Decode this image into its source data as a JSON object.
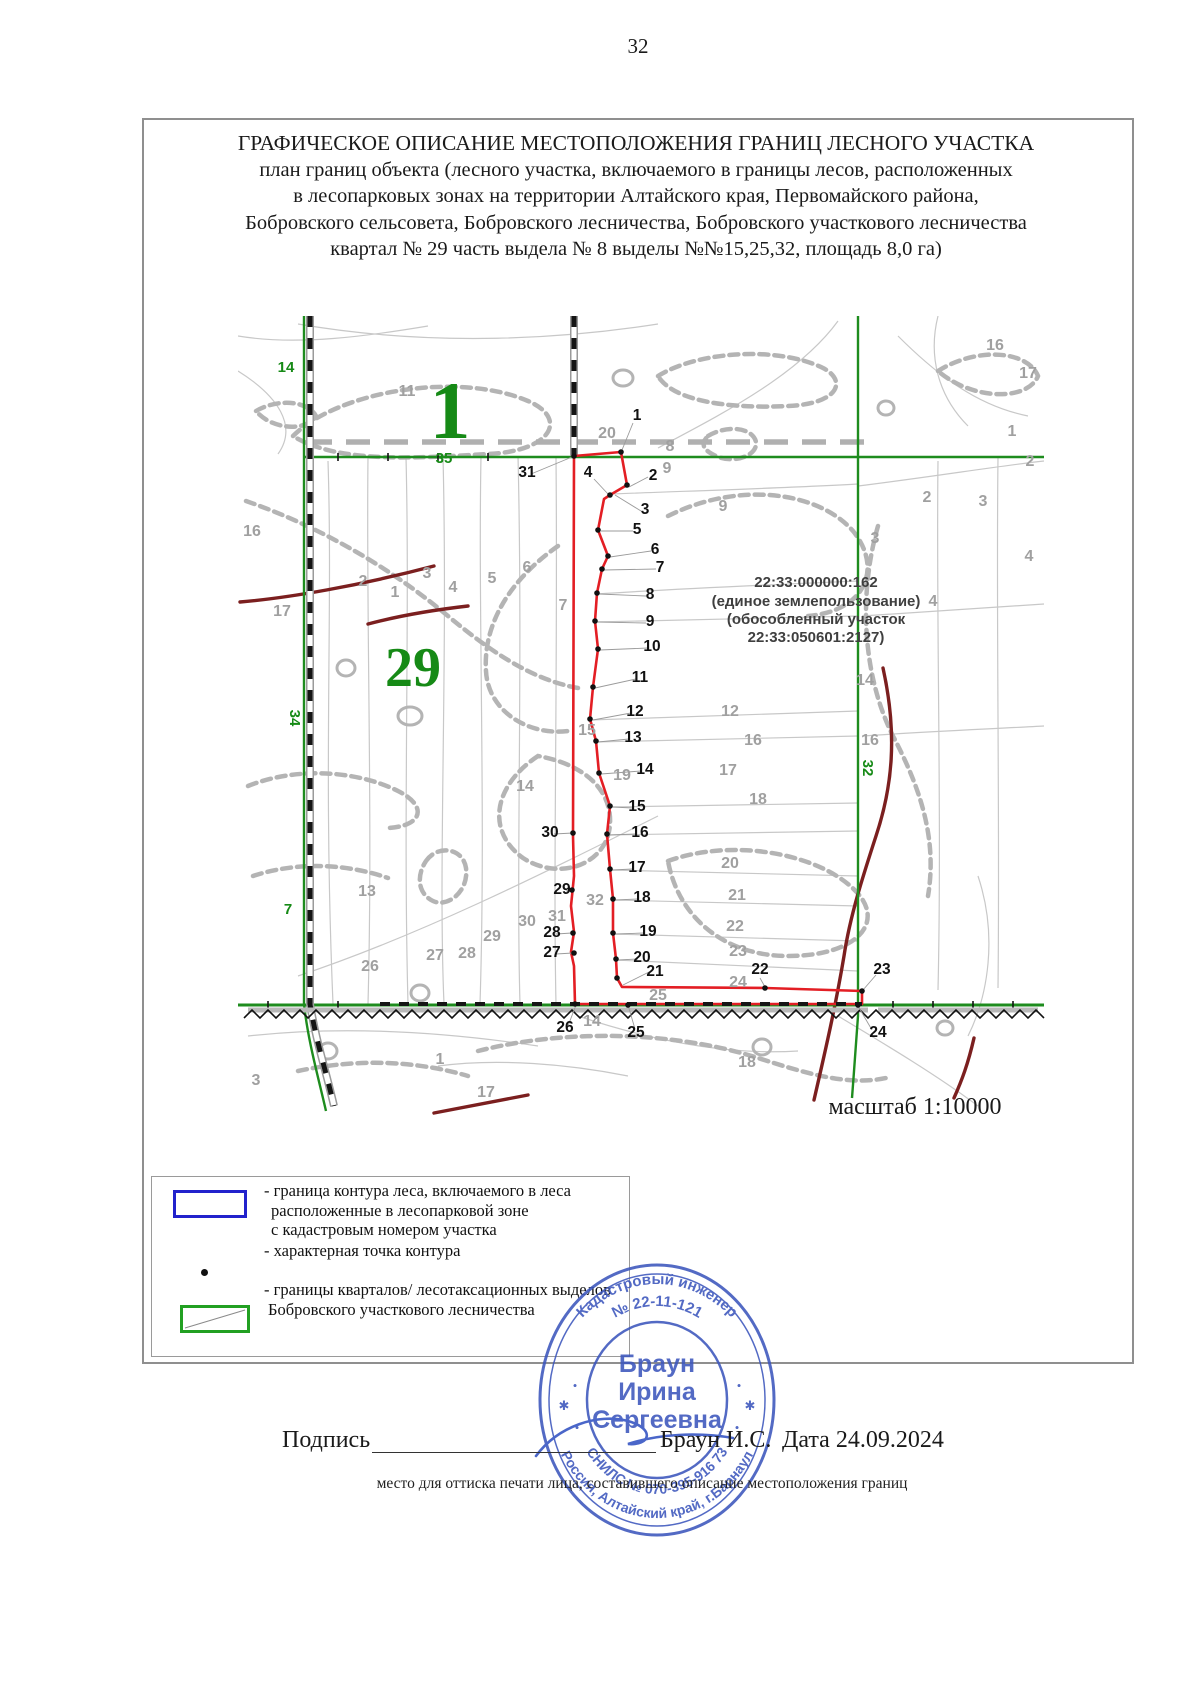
{
  "page_number": "32",
  "title": {
    "line1": "ГРАФИЧЕСКОЕ ОПИСАНИЕ МЕСТОПОЛОЖЕНИЯ ГРАНИЦ ЛЕСНОГО УЧАСТКА",
    "line2": "план границ объекта (лесного участка, включаемого в границы лесов, расположенных",
    "line3": "в лесопарковых зонах на территории Алтайского края, Первомайского района,",
    "line4": "Бобровского сельсовета, Бобровского лесничества, Бобровского участкового лесничества",
    "line5": "квартал № 29 часть выдела № 8 выделы №№15,25,32, площадь 8,0 га)"
  },
  "map": {
    "scale_label": "масштаб 1:10000",
    "cadastral_note": [
      "22:33:000000:162",
      "(единое землепользование)",
      "(обособленный участок",
      "22:33:050601:2127)"
    ],
    "labels": [
      {
        "t": "1",
        "x": 212,
        "y": 122,
        "c": "q1"
      },
      {
        "t": "29",
        "x": 175,
        "y": 370,
        "c": "q2"
      },
      {
        "t": "35",
        "x": 206,
        "y": 147,
        "c": "s"
      },
      {
        "t": "14",
        "x": 48,
        "y": 56,
        "c": "s"
      },
      {
        "t": "34",
        "x": 52,
        "y": 402,
        "c": "s",
        "r": 90
      },
      {
        "t": "7",
        "x": 50,
        "y": 598,
        "c": "s"
      },
      {
        "t": "32",
        "x": 625,
        "y": 452,
        "c": "s",
        "r": 90
      },
      {
        "t": "11",
        "x": 169,
        "y": 80,
        "c": "g"
      },
      {
        "t": "16",
        "x": 14,
        "y": 220,
        "c": "g"
      },
      {
        "t": "17",
        "x": 44,
        "y": 300,
        "c": "g"
      },
      {
        "t": "2",
        "x": 125,
        "y": 270,
        "c": "g"
      },
      {
        "t": "1",
        "x": 157,
        "y": 281,
        "c": "g"
      },
      {
        "t": "3",
        "x": 189,
        "y": 262,
        "c": "g"
      },
      {
        "t": "4",
        "x": 215,
        "y": 276,
        "c": "g"
      },
      {
        "t": "5",
        "x": 254,
        "y": 267,
        "c": "g"
      },
      {
        "t": "6",
        "x": 289,
        "y": 256,
        "c": "g"
      },
      {
        "t": "7",
        "x": 325,
        "y": 294,
        "c": "g"
      },
      {
        "t": "20",
        "x": 369,
        "y": 122,
        "c": "g"
      },
      {
        "t": "8",
        "x": 432,
        "y": 135,
        "c": "g"
      },
      {
        "t": "9",
        "x": 429,
        "y": 157,
        "c": "g"
      },
      {
        "t": "16",
        "x": 757,
        "y": 34,
        "c": "g"
      },
      {
        "t": "17",
        "x": 790,
        "y": 62,
        "c": "g"
      },
      {
        "t": "1",
        "x": 774,
        "y": 120,
        "c": "g"
      },
      {
        "t": "2",
        "x": 792,
        "y": 150,
        "c": "g"
      },
      {
        "t": "9",
        "x": 485,
        "y": 195,
        "c": "g"
      },
      {
        "t": "2",
        "x": 689,
        "y": 186,
        "c": "g"
      },
      {
        "t": "3",
        "x": 637,
        "y": 227,
        "c": "g"
      },
      {
        "t": "3",
        "x": 745,
        "y": 190,
        "c": "g"
      },
      {
        "t": "4",
        "x": 695,
        "y": 290,
        "c": "g"
      },
      {
        "t": "4",
        "x": 791,
        "y": 245,
        "c": "g"
      },
      {
        "t": "12",
        "x": 492,
        "y": 400,
        "c": "g"
      },
      {
        "t": "14",
        "x": 627,
        "y": 369,
        "c": "g"
      },
      {
        "t": "15",
        "x": 349,
        "y": 419,
        "c": "g"
      },
      {
        "t": "16",
        "x": 515,
        "y": 429,
        "c": "g"
      },
      {
        "t": "16",
        "x": 632,
        "y": 429,
        "c": "g"
      },
      {
        "t": "17",
        "x": 490,
        "y": 459,
        "c": "g"
      },
      {
        "t": "18",
        "x": 520,
        "y": 488,
        "c": "g"
      },
      {
        "t": "19",
        "x": 384,
        "y": 464,
        "c": "g"
      },
      {
        "t": "20",
        "x": 492,
        "y": 552,
        "c": "g"
      },
      {
        "t": "21",
        "x": 499,
        "y": 584,
        "c": "g"
      },
      {
        "t": "22",
        "x": 497,
        "y": 615,
        "c": "g"
      },
      {
        "t": "23",
        "x": 500,
        "y": 640,
        "c": "g"
      },
      {
        "t": "24",
        "x": 500,
        "y": 671,
        "c": "g"
      },
      {
        "t": "25",
        "x": 420,
        "y": 684,
        "c": "g"
      },
      {
        "t": "13",
        "x": 129,
        "y": 580,
        "c": "g"
      },
      {
        "t": "26",
        "x": 132,
        "y": 655,
        "c": "g"
      },
      {
        "t": "27",
        "x": 197,
        "y": 644,
        "c": "g"
      },
      {
        "t": "28",
        "x": 229,
        "y": 642,
        "c": "g"
      },
      {
        "t": "29",
        "x": 254,
        "y": 625,
        "c": "g"
      },
      {
        "t": "30",
        "x": 289,
        "y": 610,
        "c": "g"
      },
      {
        "t": "31",
        "x": 319,
        "y": 605,
        "c": "g"
      },
      {
        "t": "32",
        "x": 357,
        "y": 589,
        "c": "g"
      },
      {
        "t": "14",
        "x": 287,
        "y": 475,
        "c": "g"
      },
      {
        "t": "14",
        "x": 354,
        "y": 710,
        "c": "g"
      },
      {
        "t": "1",
        "x": 202,
        "y": 748,
        "c": "g"
      },
      {
        "t": "3",
        "x": 18,
        "y": 769,
        "c": "g"
      },
      {
        "t": "18",
        "x": 509,
        "y": 751,
        "c": "g"
      },
      {
        "t": "17",
        "x": 248,
        "y": 781,
        "c": "g"
      },
      {
        "t": "1",
        "x": 399,
        "y": 104,
        "c": "v"
      },
      {
        "t": "2",
        "x": 415,
        "y": 164,
        "c": "v"
      },
      {
        "t": "3",
        "x": 407,
        "y": 198,
        "c": "v"
      },
      {
        "t": "4",
        "x": 350,
        "y": 161,
        "c": "v"
      },
      {
        "t": "5",
        "x": 399,
        "y": 218,
        "c": "v"
      },
      {
        "t": "6",
        "x": 417,
        "y": 238,
        "c": "v"
      },
      {
        "t": "7",
        "x": 422,
        "y": 256,
        "c": "v"
      },
      {
        "t": "8",
        "x": 412,
        "y": 283,
        "c": "v"
      },
      {
        "t": "9",
        "x": 412,
        "y": 310,
        "c": "v"
      },
      {
        "t": "10",
        "x": 414,
        "y": 335,
        "c": "v"
      },
      {
        "t": "11",
        "x": 402,
        "y": 366,
        "c": "v"
      },
      {
        "t": "12",
        "x": 397,
        "y": 400,
        "c": "v"
      },
      {
        "t": "13",
        "x": 395,
        "y": 426,
        "c": "v"
      },
      {
        "t": "14",
        "x": 407,
        "y": 458,
        "c": "v"
      },
      {
        "t": "15",
        "x": 399,
        "y": 495,
        "c": "v"
      },
      {
        "t": "16",
        "x": 402,
        "y": 521,
        "c": "v"
      },
      {
        "t": "17",
        "x": 399,
        "y": 556,
        "c": "v"
      },
      {
        "t": "18",
        "x": 404,
        "y": 586,
        "c": "v"
      },
      {
        "t": "19",
        "x": 410,
        "y": 620,
        "c": "v"
      },
      {
        "t": "20",
        "x": 404,
        "y": 646,
        "c": "v"
      },
      {
        "t": "21",
        "x": 417,
        "y": 660,
        "c": "v"
      },
      {
        "t": "22",
        "x": 522,
        "y": 658,
        "c": "v"
      },
      {
        "t": "23",
        "x": 644,
        "y": 658,
        "c": "v"
      },
      {
        "t": "24",
        "x": 640,
        "y": 721,
        "c": "v"
      },
      {
        "t": "25",
        "x": 398,
        "y": 721,
        "c": "v"
      },
      {
        "t": "26",
        "x": 327,
        "y": 716,
        "c": "v"
      },
      {
        "t": "27",
        "x": 314,
        "y": 641,
        "c": "v"
      },
      {
        "t": "28",
        "x": 314,
        "y": 621,
        "c": "v"
      },
      {
        "t": "29",
        "x": 324,
        "y": 578,
        "c": "v"
      },
      {
        "t": "30",
        "x": 312,
        "y": 521,
        "c": "v"
      },
      {
        "t": "31",
        "x": 289,
        "y": 161,
        "c": "v"
      }
    ]
  },
  "legend": {
    "items": [
      {
        "symbol": "blue-rect",
        "lines": [
          "- граница контура леса, включаемого в леса",
          "расположенные в лесопарковой зоне",
          "с кадастровым номером участка"
        ]
      },
      {
        "symbol": "point-dot",
        "lines": [
          "- характерная точка контура"
        ]
      },
      {
        "symbol": "green-rect",
        "lines": [
          "- границы кварталов/ лесотаксационных выделов",
          "Бобровского участкового лесничества"
        ]
      }
    ]
  },
  "signature": {
    "label": "Подпись",
    "name": "Браун И.С.",
    "date_label": "Дата",
    "date_value": "24.09.2024",
    "note": "место для оттиска печати лица, составившего описание местоположения границ"
  },
  "stamp": {
    "arc_top": "Кадастровый инженер",
    "arc_number": "№ 22-11-121",
    "center_line1": "Браун",
    "center_line2": "Ирина",
    "center_line3": "Сергеевна",
    "arc_bottom_outer": "Россия, Алтайский край, г.Барнаул",
    "arc_bottom_inner": "СНИЛС № 070-395-916 73"
  },
  "colors": {
    "parcel_red": "#e31e24",
    "quartal_green": "#1e8c1e",
    "label_green": "#168a16",
    "maroon": "#7b1f1f",
    "contour_gray": "#c8c8c8",
    "stamp_blue": "#3c56bd",
    "legend_blue": "#2222cc"
  }
}
